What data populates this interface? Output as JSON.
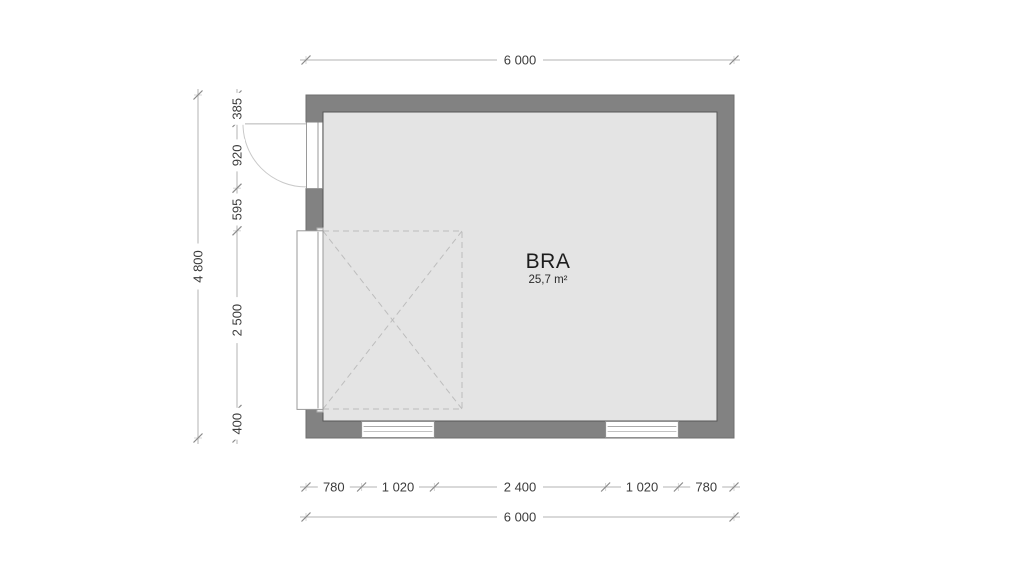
{
  "drawing": {
    "room": {
      "label": "BRA",
      "area": "25,7 m²"
    },
    "dimensions": {
      "top_total": "6 000",
      "left_total": "4 800",
      "left_chain": [
        "385",
        "920",
        "595",
        "2 500",
        "400"
      ],
      "bottom_chain": [
        "780",
        "1 020",
        "2 400",
        "1 020",
        "780"
      ],
      "bottom_total": "6 000"
    },
    "colors": {
      "wall": "#828282",
      "floor": "#e4e4e4",
      "dimension_line": "#b3b3b3",
      "text": "#3c3c3c"
    }
  }
}
